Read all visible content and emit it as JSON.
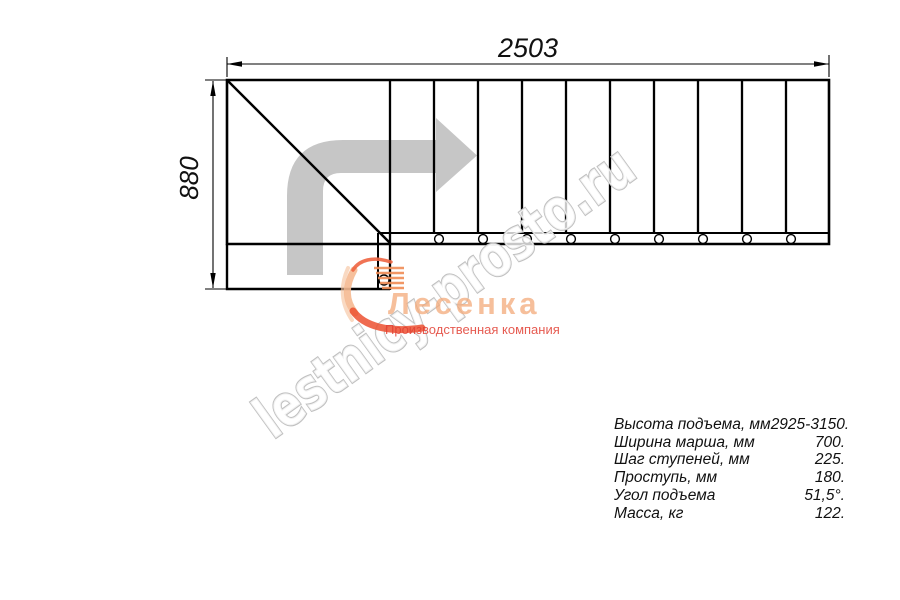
{
  "dimensions": {
    "width_mm": "2503",
    "depth_mm": "880"
  },
  "specs": {
    "rows": [
      {
        "label": "Высота подъема, мм",
        "value": "2925-3150."
      },
      {
        "label": "Ширина марша, мм",
        "value": "700."
      },
      {
        "label": "Шаг ступеней, мм",
        "value": "225."
      },
      {
        "label": "Проступь, мм",
        "value": "180."
      },
      {
        "label": "Угол подъема",
        "value": "51,5°."
      },
      {
        "label": "Масса, кг",
        "value": "122."
      }
    ]
  },
  "watermark": {
    "text": "lestnicy-prosto.ru"
  },
  "logo": {
    "name": "Лесенка",
    "tagline": "Производственная компания"
  },
  "colors": {
    "line": "#000000",
    "direction_arrow": "#c6c6c6",
    "watermark_outline": "#c0c0c0",
    "logo_orange": "#f2a878",
    "logo_red": "#e2453b"
  }
}
